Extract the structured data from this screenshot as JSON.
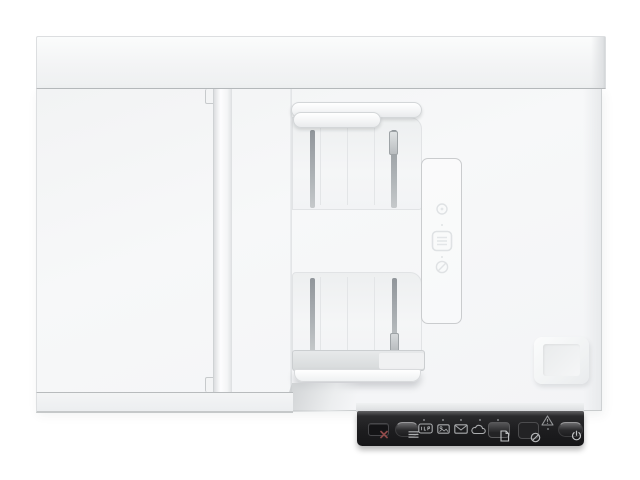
{
  "meta": {
    "scene_description": "Top-down product photograph of a white flatbed document scanner with an automatic document feeder (ADF) and a black control-panel strip at the lower right. No on-screen text; all controls are physical buttons and indicator icons.",
    "background_color": "#ffffff"
  },
  "colors": {
    "device_white": "#f5f6f7",
    "top_cover": "#f3f4f5",
    "seam_line": "#b8bbbd",
    "slot_gray": "#9aa0a3",
    "guide_bar": "#f4f5f6",
    "stop_bar_gray": "#dcdedf",
    "panel_black": "#1d1d1f",
    "panel_highlight": "#626264",
    "cancel_x_red": "#8f4a4a",
    "icon_gray": "#aeb0b2",
    "led_gray": "#85878a",
    "embossed_line": "#dfe2e4"
  },
  "scanner": {
    "top_cover": {
      "label": "rear top cover bar"
    },
    "flatbed_lid": {
      "label": "flatbed scanner lid"
    },
    "hinge_rail": {
      "label": "lid hinge rail with top and bottom notch tabs"
    },
    "adf": {
      "input_tray": {
        "label": "ADF input tray",
        "paper_guides": [
          "rear paper guide bar",
          "front paper guide bar"
        ],
        "guide_slots": 2,
        "slider_handle": "right guide slider"
      },
      "output_tray": {
        "label": "ADF output tray",
        "guide_slots": 2,
        "slider_handle": "right guide slider",
        "front_bars": [
          "gray paper stop bar",
          "white output tray lip"
        ]
      },
      "instruction_panel": {
        "label": "embossed paper-loading instruction panel",
        "icons": [
          "circle-badge-icon",
          "load-document-icon",
          "no-staples-icon"
        ]
      }
    },
    "hinge_pad": {
      "label": "raised hinge pad, lower right"
    },
    "control_panel": {
      "label": "black control panel strip",
      "buttons": [
        {
          "id": "cancel",
          "label": "Cancel",
          "icon": "cancel-x-icon",
          "glyph": "✕",
          "color": "#8f4a4a"
        },
        {
          "id": "feed-mode",
          "label": "Paper feed mode",
          "icon": "stacked-lines-icon",
          "glyph": "≡"
        },
        {
          "id": "scan",
          "label": "Scan to file",
          "icon": "document-icon",
          "glyph": "🗎"
        },
        {
          "id": "settings",
          "label": "Scan options",
          "icon": "ring-slash-icon",
          "glyph": "⊘"
        },
        {
          "id": "power",
          "label": "Power",
          "icon": "power-icon",
          "glyph": "⏻"
        }
      ],
      "indicators": [
        {
          "id": "scan-to-pdf",
          "label": "Scan to PDF indicator",
          "icon": "pdf-badge-icon"
        },
        {
          "id": "scan-to-picture",
          "label": "Scan to picture indicator",
          "icon": "picture-icon"
        },
        {
          "id": "scan-to-email",
          "label": "Scan to email indicator",
          "icon": "envelope-icon",
          "glyph": "✉"
        },
        {
          "id": "scan-to-cloud",
          "label": "Scan to cloud indicator",
          "icon": "cloud-icon",
          "glyph": "☁"
        }
      ],
      "status": {
        "warning": {
          "label": "Error / warning indicator",
          "icon": "warning-triangle-icon",
          "glyph": "⚠"
        },
        "led_dots": 6
      }
    }
  }
}
